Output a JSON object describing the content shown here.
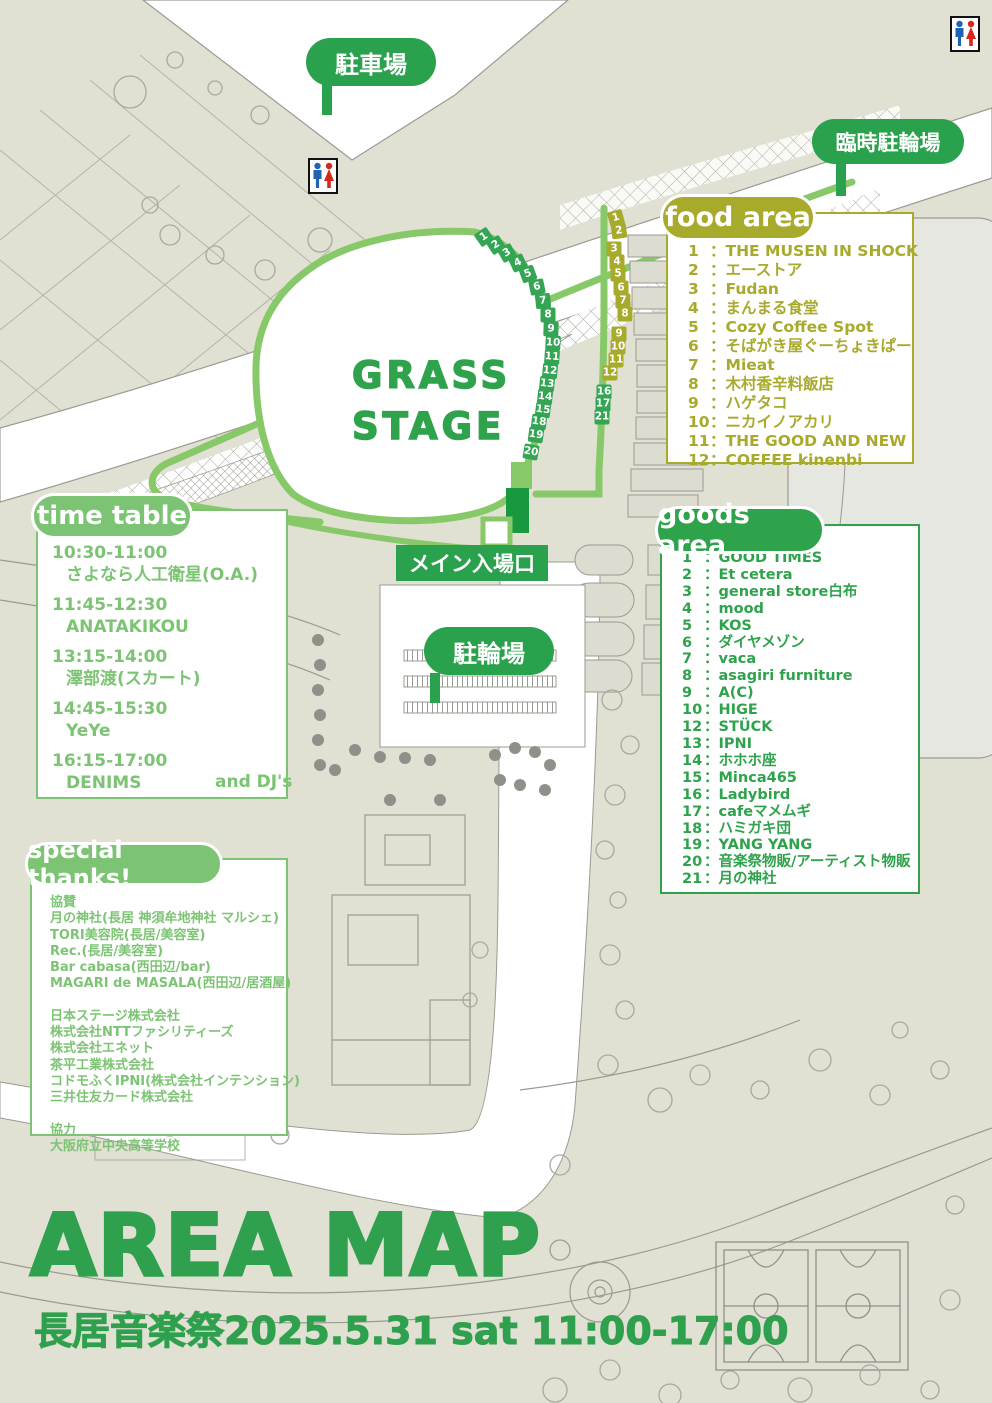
{
  "event": {
    "title": "AREA MAP",
    "subtitle": "長居音楽祭2025.5.31 sat 11:00-17:00"
  },
  "map_labels": {
    "parking": "駐車場",
    "temp_bike_parking": "臨時駐輪場",
    "bike_parking": "駐輪場",
    "main_entrance": "メイン入場口",
    "stage_line1": "GRASS",
    "stage_line2": "STAGE"
  },
  "food_area": {
    "title": "food area",
    "sep": "：",
    "color": "#a8aa2c",
    "items": [
      {
        "n": "1",
        "name": "THE MUSEN IN SHOCK"
      },
      {
        "n": "2",
        "name": "エーストア"
      },
      {
        "n": "3",
        "name": "Fudan"
      },
      {
        "n": "4",
        "name": "まんまる食堂"
      },
      {
        "n": "5",
        "name": "Cozy Coffee Spot"
      },
      {
        "n": "6",
        "name": "そばがき屋ぐーちょきぱー"
      },
      {
        "n": "7",
        "name": "Mieat"
      },
      {
        "n": "8",
        "name": "木村香辛料飯店"
      },
      {
        "n": "9",
        "name": "ハゲタコ"
      },
      {
        "n": "10",
        "name": "ニカイノアカリ"
      },
      {
        "n": "11",
        "name": "THE GOOD AND NEW"
      },
      {
        "n": "12",
        "name": "COFFEE kinenbi"
      }
    ]
  },
  "goods_area": {
    "title": "goods area",
    "sep": "：",
    "color": "#2fa24c",
    "items": [
      {
        "n": "1",
        "name": "GOOD TIMES"
      },
      {
        "n": "2",
        "name": "Et cetera"
      },
      {
        "n": "3",
        "name": "general store白布"
      },
      {
        "n": "4",
        "name": "mood"
      },
      {
        "n": "5",
        "name": "KOS"
      },
      {
        "n": "6",
        "name": "ダイヤメゾン"
      },
      {
        "n": "7",
        "name": "vaca"
      },
      {
        "n": "8",
        "name": "asagiri furniture"
      },
      {
        "n": "9",
        "name": "A(C)"
      },
      {
        "n": "10",
        "name": "HIGE"
      },
      {
        "n": "12",
        "name": "STÜCK"
      },
      {
        "n": "13",
        "name": "IPNI"
      },
      {
        "n": "14",
        "name": "ホホホ座"
      },
      {
        "n": "15",
        "name": "Minca465"
      },
      {
        "n": "16",
        "name": "Ladybird"
      },
      {
        "n": "17",
        "name": "cafeマメムギ"
      },
      {
        "n": "18",
        "name": "ハミガキ団"
      },
      {
        "n": "19",
        "name": "YANG YANG"
      },
      {
        "n": "20",
        "name": "音楽祭物販/アーティスト物販"
      },
      {
        "n": "21",
        "name": "月の神社"
      }
    ]
  },
  "time_table": {
    "title": "time table",
    "color": "#7cc474",
    "slots": [
      {
        "time": "10:30-11:00",
        "artist": "さよなら人工衛星(O.A.)"
      },
      {
        "time": "11:45-12:30",
        "artist": "ANATAKIKOU"
      },
      {
        "time": "13:15-14:00",
        "artist": "澤部渡(スカート)"
      },
      {
        "time": "14:45-15:30",
        "artist": "YeYe"
      },
      {
        "time": "16:15-17:00",
        "artist": "DENIMS"
      }
    ],
    "footer": "and DJ's"
  },
  "special_thanks": {
    "title": "special thanks!",
    "lines": [
      "協賛",
      "月の神社(長居 神須牟地神社 マルシェ)",
      "TORI美容院(長居/美容室)",
      "Rec.(長居/美容室)",
      "Bar cabasa(西田辺/bar)",
      "MAGARI de MASALA(西田辺/居酒屋)",
      "",
      "日本ステージ株式会社",
      "株式会社NTTファシリティーズ",
      "株式会社エネット",
      "茶平工業株式会社",
      "コドモふくIPNI(株式会社インテンション)",
      "三井住友カード株式会社",
      "",
      "協力",
      "大阪府立中央高等学校"
    ]
  },
  "markers": {
    "colors": {
      "goods": "#33a553",
      "food": "#a8aa2c"
    },
    "goods_left": [
      {
        "n": "1",
        "x": 484,
        "y": 237,
        "rot": -35
      },
      {
        "n": "2",
        "x": 496,
        "y": 245,
        "rot": -33
      },
      {
        "n": "3",
        "x": 507,
        "y": 253,
        "rot": -30
      },
      {
        "n": "4",
        "x": 518,
        "y": 263,
        "rot": -25
      },
      {
        "n": "5",
        "x": 528,
        "y": 274,
        "rot": -20
      },
      {
        "n": "6",
        "x": 537,
        "y": 287,
        "rot": -12
      },
      {
        "n": "7",
        "x": 543,
        "y": 301,
        "rot": -6
      },
      {
        "n": "8",
        "x": 548,
        "y": 315,
        "rot": 0
      },
      {
        "n": "9",
        "x": 551,
        "y": 329,
        "rot": 2
      },
      {
        "n": "10",
        "x": 553,
        "y": 343,
        "rot": 3
      },
      {
        "n": "11",
        "x": 552,
        "y": 357,
        "rot": 4
      },
      {
        "n": "12",
        "x": 550,
        "y": 371,
        "rot": 5
      },
      {
        "n": "13",
        "x": 547,
        "y": 384,
        "rot": 6
      },
      {
        "n": "14",
        "x": 545,
        "y": 397,
        "rot": 6
      },
      {
        "n": "15",
        "x": 543,
        "y": 410,
        "rot": 7
      },
      {
        "n": "18",
        "x": 539,
        "y": 422,
        "rot": 7
      },
      {
        "n": "19",
        "x": 536,
        "y": 435,
        "rot": 8
      },
      {
        "n": "20",
        "x": 531,
        "y": 452,
        "rot": 10
      }
    ],
    "food_right": [
      {
        "n": "1",
        "x": 616,
        "y": 218,
        "rot": -16
      },
      {
        "n": "2",
        "x": 619,
        "y": 231,
        "rot": -8
      },
      {
        "n": "3",
        "x": 614,
        "y": 249,
        "rot": 0
      },
      {
        "n": "4",
        "x": 617,
        "y": 262,
        "rot": 0
      },
      {
        "n": "5",
        "x": 618,
        "y": 274,
        "rot": 0
      },
      {
        "n": "6",
        "x": 621,
        "y": 288,
        "rot": 0
      },
      {
        "n": "7",
        "x": 623,
        "y": 301,
        "rot": 0
      },
      {
        "n": "8",
        "x": 625,
        "y": 314,
        "rot": 0
      },
      {
        "n": "9",
        "x": 619,
        "y": 334,
        "rot": 0
      },
      {
        "n": "10",
        "x": 618,
        "y": 347,
        "rot": 0
      },
      {
        "n": "11",
        "x": 616,
        "y": 360,
        "rot": 0
      },
      {
        "n": "12",
        "x": 610,
        "y": 373,
        "rot": 0
      }
    ],
    "goods_right": [
      {
        "n": "16",
        "x": 604,
        "y": 392,
        "rot": 0
      },
      {
        "n": "17",
        "x": 603,
        "y": 404,
        "rot": 0
      },
      {
        "n": "21",
        "x": 602,
        "y": 417,
        "rot": 0
      }
    ]
  }
}
